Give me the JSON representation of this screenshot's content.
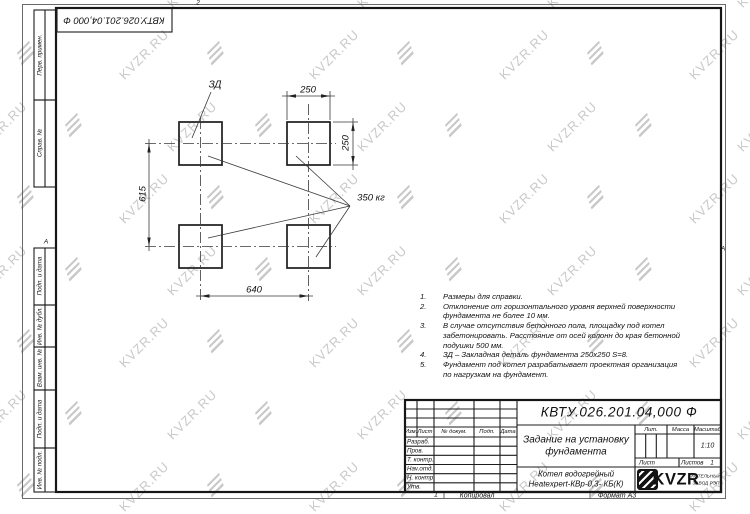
{
  "designation": "КВТУ.026.201.04,000 Ф",
  "watermark": {
    "text": "KVZR.RU"
  },
  "zone_markers": {
    "top": "2",
    "left": "А",
    "right": "А",
    "bottom": "1"
  },
  "side_stamps": [
    {
      "label": "Перв. примен."
    },
    {
      "label": "Справ. №"
    },
    {
      "label": "Подп. и дата"
    },
    {
      "label": "Инв. № дубл."
    },
    {
      "label": "Взам. инв. №"
    },
    {
      "label": "Подп. и дата"
    },
    {
      "label": "Инв. № подл."
    }
  ],
  "drawing": {
    "embed_label": "ЗД",
    "load_label": "350 кг",
    "dim_top": "250",
    "dim_right": "250",
    "dim_left": "615",
    "dim_bottom": "640"
  },
  "notes": [
    {
      "n": "1.",
      "text": "Размеры для справки."
    },
    {
      "n": "2.",
      "text": "Отклонение от горизонтального уровня верхней поверхности фундамента не более 10 мм."
    },
    {
      "n": "3.",
      "text": "В случае отсутствия бетонного пола, площадку под котел забетонировать. Расстояние от осей колонн до края бетонной подушки 500 мм."
    },
    {
      "n": "4.",
      "text": "ЗД – Закладная деталь фундамента 250х250 S=8."
    },
    {
      "n": "5.",
      "text": "Фундамент под котел разрабатывает проектная организация по нагрузкам на фундамент."
    }
  ],
  "title_block": {
    "title_line1": "Задание на установку",
    "title_line2": "фундамента",
    "product_line1": "Котел водогрейный",
    "product_line2": "Heatexpert-КВр-0,3- КБ(К)",
    "cols": [
      "Изм.",
      "Лист",
      "№ докум.",
      "Подп.",
      "Дата"
    ],
    "rows": [
      "Разраб.",
      "Пров.",
      "Т. контр.",
      "Нач.отд.",
      "Н. контр.",
      "Утв."
    ],
    "lit": "Лит.",
    "mass": "Масса",
    "scale": "Масштаб",
    "scale_value": "1:10",
    "sheet": "Лист",
    "sheets": "Листов",
    "sheets_value": "1",
    "logo_text": "KVZR",
    "logo_sub1": "КОТЕЛЬНЫЙ",
    "logo_sub2": "ЗАВОД РЭП",
    "copied": "Копировал",
    "format": "Формат А3"
  }
}
